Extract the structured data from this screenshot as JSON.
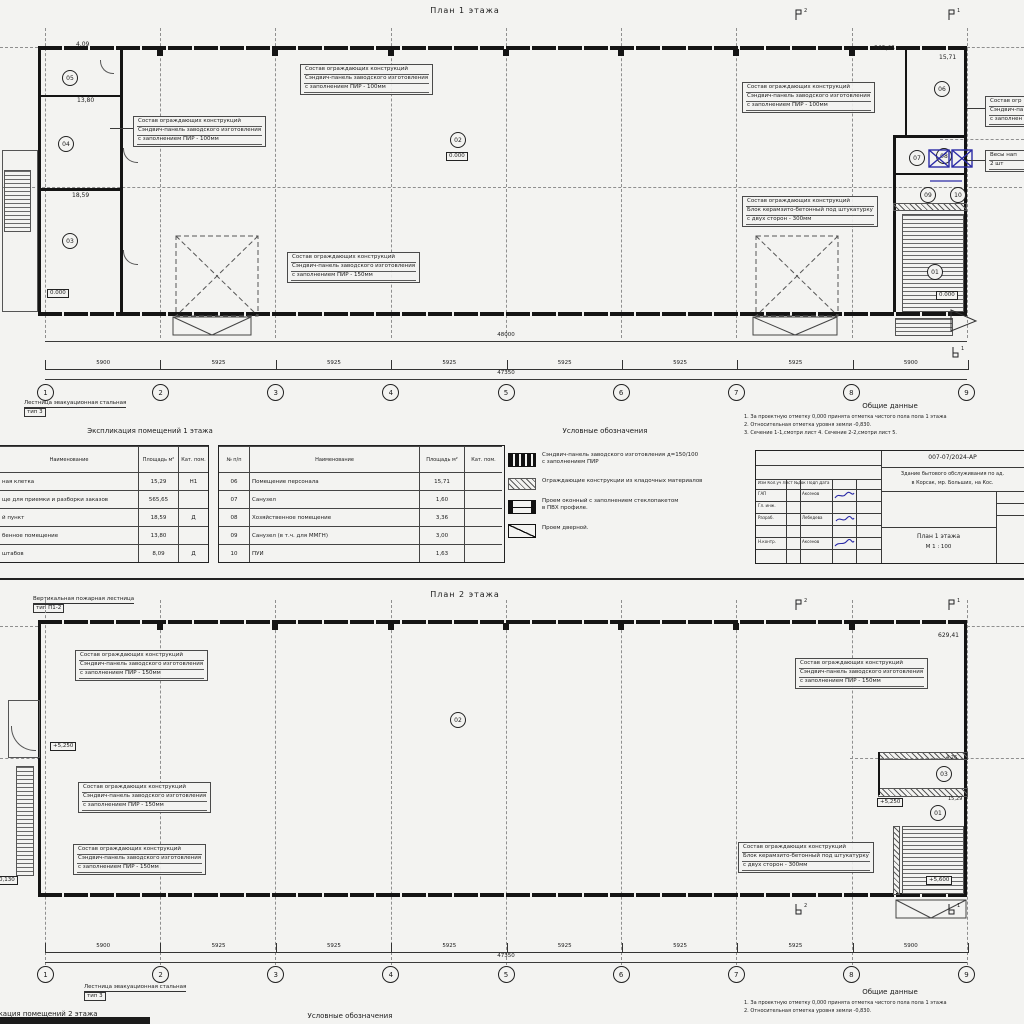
{
  "colors": {
    "paper": "#f3f3f1",
    "ink": "#1b1b1b",
    "blue": "#2b2ba6"
  },
  "sheet1": {
    "title": "План 1 этажа",
    "rooms": {
      "r01": "01",
      "r02": "02",
      "r03": "03",
      "r04": "04",
      "r05": "05",
      "r06": "06",
      "r07": "07",
      "r08": "08",
      "r09": "09",
      "r10": "10"
    },
    "areas": {
      "hall": "565,65",
      "room06": "15,71",
      "room05": "4,09",
      "room04": "13,80",
      "room03": "18,59"
    },
    "elev": "0.000",
    "totals": {
      "top": "48000",
      "bottom": "47350"
    },
    "spans": [
      "5900",
      "5925",
      "5925",
      "5925",
      "5925",
      "5925",
      "5925",
      "5900"
    ],
    "grid": [
      "1",
      "2",
      "3",
      "4",
      "5",
      "6",
      "7",
      "8",
      "9"
    ],
    "flags": {
      "s2": "2",
      "s1": "1"
    },
    "stair_note": {
      "l1": "Лестница эвакуационная стальная",
      "l2": "тип 3"
    }
  },
  "sheet2": {
    "title": "План 2 этажа",
    "fire_note": {
      "l1": "Вертикальная пожарная лестница",
      "l2": "тип П1-2"
    },
    "rooms": {
      "r01": "01",
      "r02": "02",
      "r03": "03"
    },
    "areas": {
      "hall": "629,41",
      "room01": "15,29",
      "room03": "4,26"
    },
    "elev": {
      "floor": "+5,250",
      "stair": "+5,600",
      "entry": "-0,130"
    },
    "totals": {
      "bottom": "47350"
    },
    "spans": [
      "5900",
      "5925",
      "5925",
      "5925",
      "5925",
      "5925",
      "5925",
      "5900"
    ],
    "grid": [
      "1",
      "2",
      "3",
      "4",
      "5",
      "6",
      "7",
      "8",
      "9"
    ],
    "flags": {
      "s2": "2",
      "s1": "1"
    },
    "stair_note": {
      "l1": "Лестница эвакуационная стальная",
      "l2": "тип 3"
    }
  },
  "callouts": {
    "pir100": {
      "l1": "Состав ограждающих конструкций",
      "l2": "Сэндвич-панель заводского изготовления",
      "l3": "с заполнением ПИР - 100мм"
    },
    "pir150": {
      "l1": "Состав ограждающих конструкций",
      "l2": "Сэндвич-панель заводского изготовления",
      "l3": "с заполнением ПИР - 150мм"
    },
    "block300": {
      "l1": "Состав ограждающих конструкций",
      "l2": "Блок керамзито-бетонный под штукатурку",
      "l3": "с двух сторон - 300мм"
    },
    "cut": {
      "l1": "Состав огр",
      "l2": "Сэндвич-па",
      "l3": "с заполнен"
    },
    "scales": {
      "l1": "Весы нап",
      "l2": "2 шт"
    }
  },
  "explication1": {
    "title": "Экспликация помещений 1 этажа",
    "headers": {
      "name": "Наименование",
      "area": "Площадь м²",
      "cat": "Кат. пом.",
      "num": "№ п/п"
    },
    "table1_rows": [
      {
        "name": "ная клетка",
        "area": "15,29",
        "cat": "Н1"
      },
      {
        "name": "ще для приемки и разборки заказов",
        "area": "565,65",
        "cat": ""
      },
      {
        "name": "й пункт",
        "area": "18,59",
        "cat": "Д"
      },
      {
        "name": "бенное помещение",
        "area": "13,80",
        "cat": ""
      },
      {
        "name": "штабов",
        "area": "8,09",
        "cat": "Д"
      }
    ],
    "table2_rows": [
      {
        "num": "06",
        "name": "Помещение персонала",
        "area": "15,71",
        "cat": ""
      },
      {
        "num": "07",
        "name": "Санузел",
        "area": "1,60",
        "cat": ""
      },
      {
        "num": "08",
        "name": "Хозяйственное помещение",
        "area": "3,36",
        "cat": ""
      },
      {
        "num": "09",
        "name": "Санузел (в т.ч. для ММГН)",
        "area": "3,00",
        "cat": ""
      },
      {
        "num": "10",
        "name": "ПУИ",
        "area": "1,63",
        "cat": ""
      }
    ]
  },
  "legend": {
    "title": "Условные обозначения",
    "items": [
      {
        "l1": "Сэндвич-панель заводского изготовления д=150/100",
        "l2": "с заполнением ПИР"
      },
      {
        "l1": "Ограждающие конструкции из кладочных материалов",
        "l2": ""
      },
      {
        "l1": "Проем оконный с заполнением стеклопакетом",
        "l2": "в ПВХ профиле."
      },
      {
        "l1": "Проем дверной.",
        "l2": ""
      }
    ]
  },
  "general": {
    "title": "Общие данные",
    "notes": [
      "1. За проектную отметку 0,000 принята отметка чистого пола пола 1 этажа",
      "2. Относительная отметка уровня земли -0,830.",
      "3. Сечение 1-1,смотри лист 4. Сечение 2-2,смотри лист 5."
    ]
  },
  "stamp": {
    "doc_no": "007-07/2024-АР",
    "project_l1": "Здание бытового обслуживания по ад.",
    "project_l2": "в Корсак, мр. Больших, на Кос.",
    "header_row": "Изм  Кол.уч  Лист  №док  Подп  Дата",
    "row1": {
      "role": "ГАП",
      "name": "Аксенов"
    },
    "row2": {
      "role": "Гл. инж.",
      "name": ""
    },
    "row3": {
      "role": "Разраб.",
      "name": "Лебедева"
    },
    "row5": {
      "role": "Н.контр.",
      "name": "Аксенов"
    },
    "drawing_title": "План 1 этажа",
    "scale": "М 1 : 100"
  },
  "bottom": {
    "expl2_title": "Экспликация помещений 2 этажа",
    "legend_title": "Условные обозначения",
    "general_title": "Общие данные",
    "notes": [
      "1. За проектную отметку 0,000 принята отметка чистого пола пола 1 этажа",
      "2. Относительная отметка уровня земли -0,830."
    ]
  }
}
